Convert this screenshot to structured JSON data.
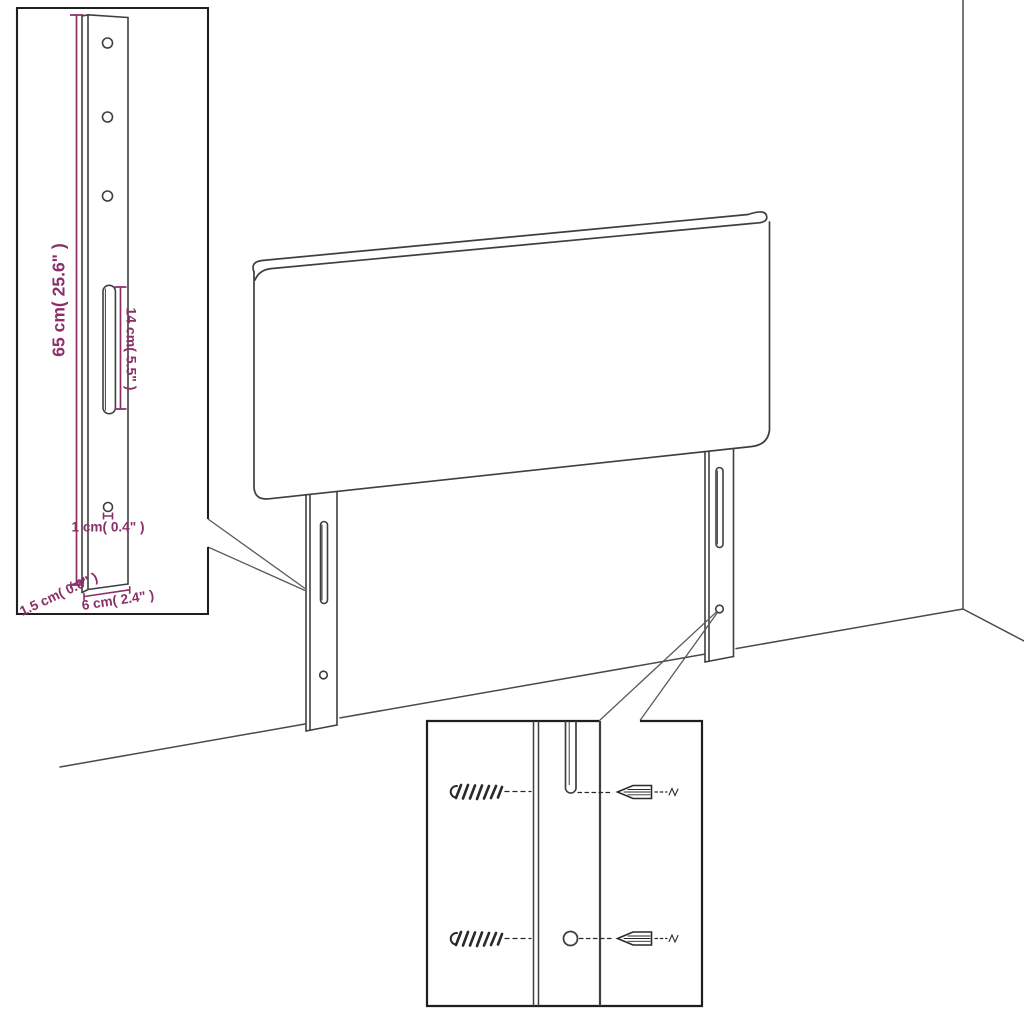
{
  "inset_bracket_detail": {
    "bracket_height_label": "65 cm( 25.6\" )",
    "slot_length_label": "14 cm( 5.5\" )",
    "hole_label": "1 cm( 0.4\" )",
    "width_label": "6 cm( 2.4\" )",
    "thickness_label": "1.5 cm( 0.6\" )"
  },
  "colors": {
    "dimension": "#8a2f68",
    "linework": "#3d3d3d",
    "inset_border": "#1f1f1f",
    "background": "#ffffff"
  }
}
